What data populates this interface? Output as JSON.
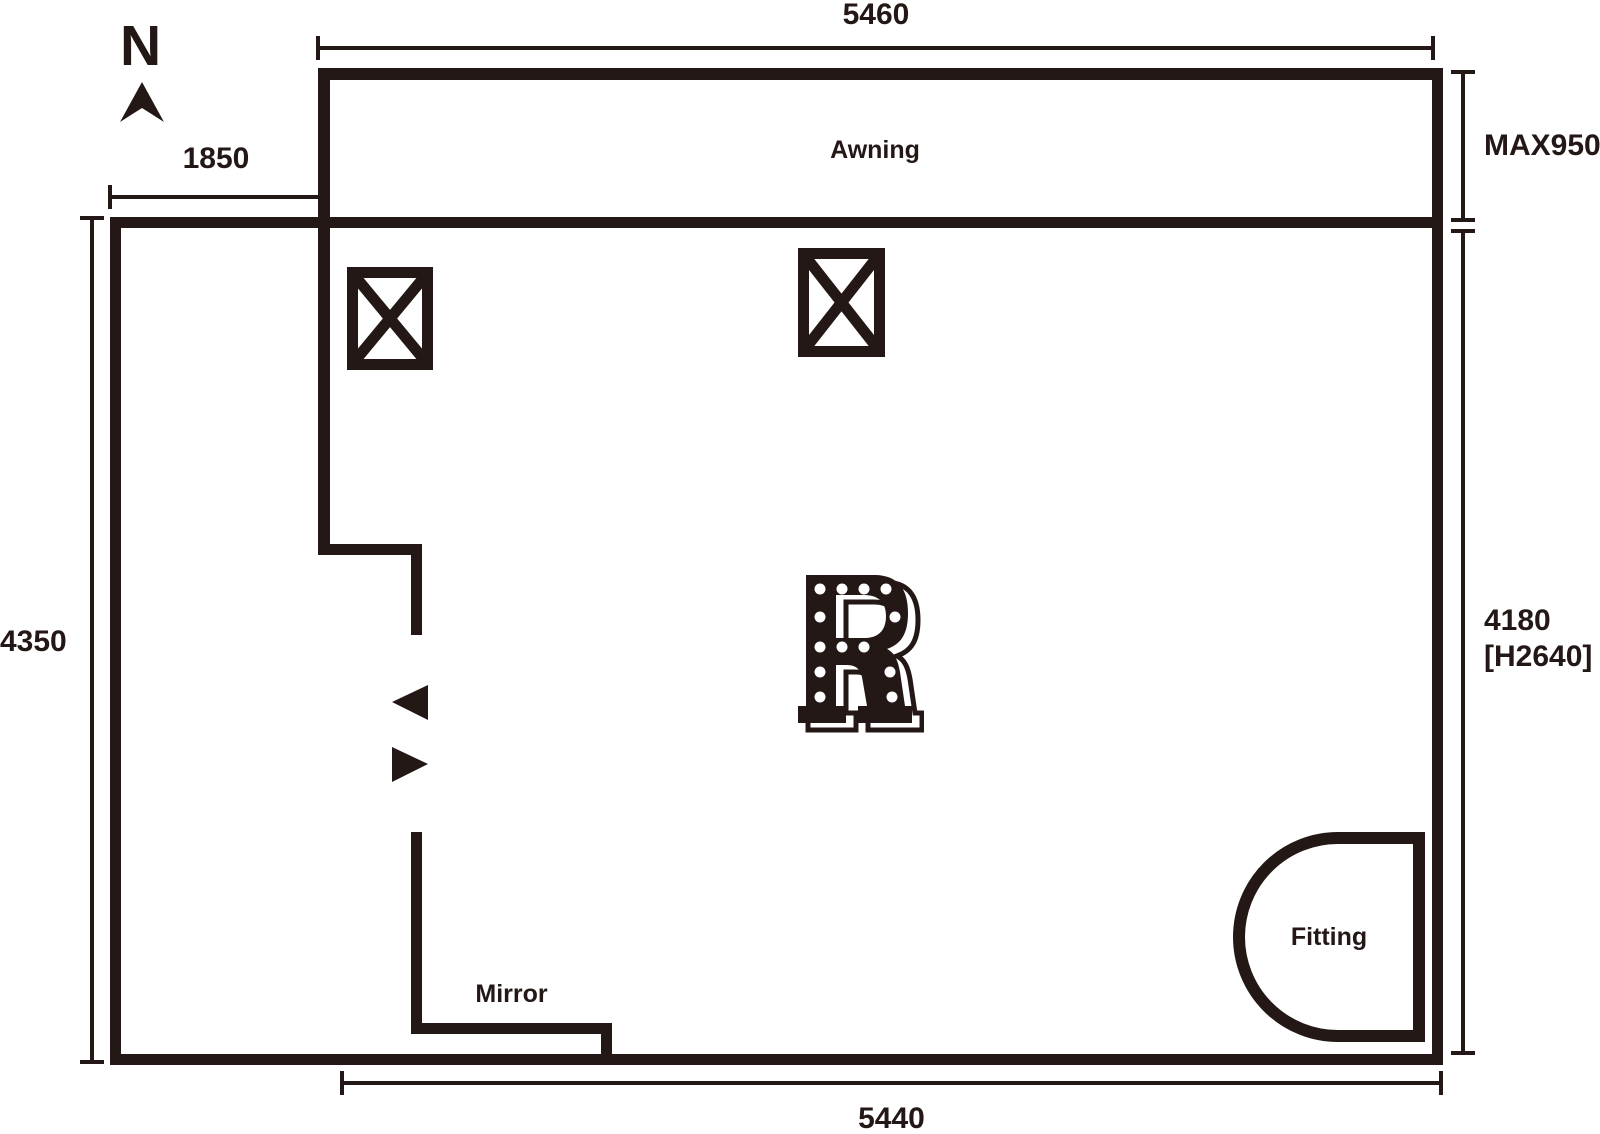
{
  "meta": {
    "title": "Store floor plan",
    "ink_color": "#231815",
    "background_color": "#ffffff"
  },
  "compass": {
    "label": "N"
  },
  "dimensions": {
    "awning_width": "5460",
    "entry_offset": "1850",
    "awning_depth": "MAX950",
    "left_depth": "4350",
    "right_depth": "4180",
    "right_height": "[H2640]",
    "room_width": "5440"
  },
  "labels": {
    "awning": "Awning",
    "mirror": "Mirror",
    "fitting": "Fitting"
  },
  "symbols": {
    "north_arrow": "north-arrow",
    "column": "column-x-box",
    "door_arrows": "door-direction-arrows",
    "logo_letter": "R"
  }
}
